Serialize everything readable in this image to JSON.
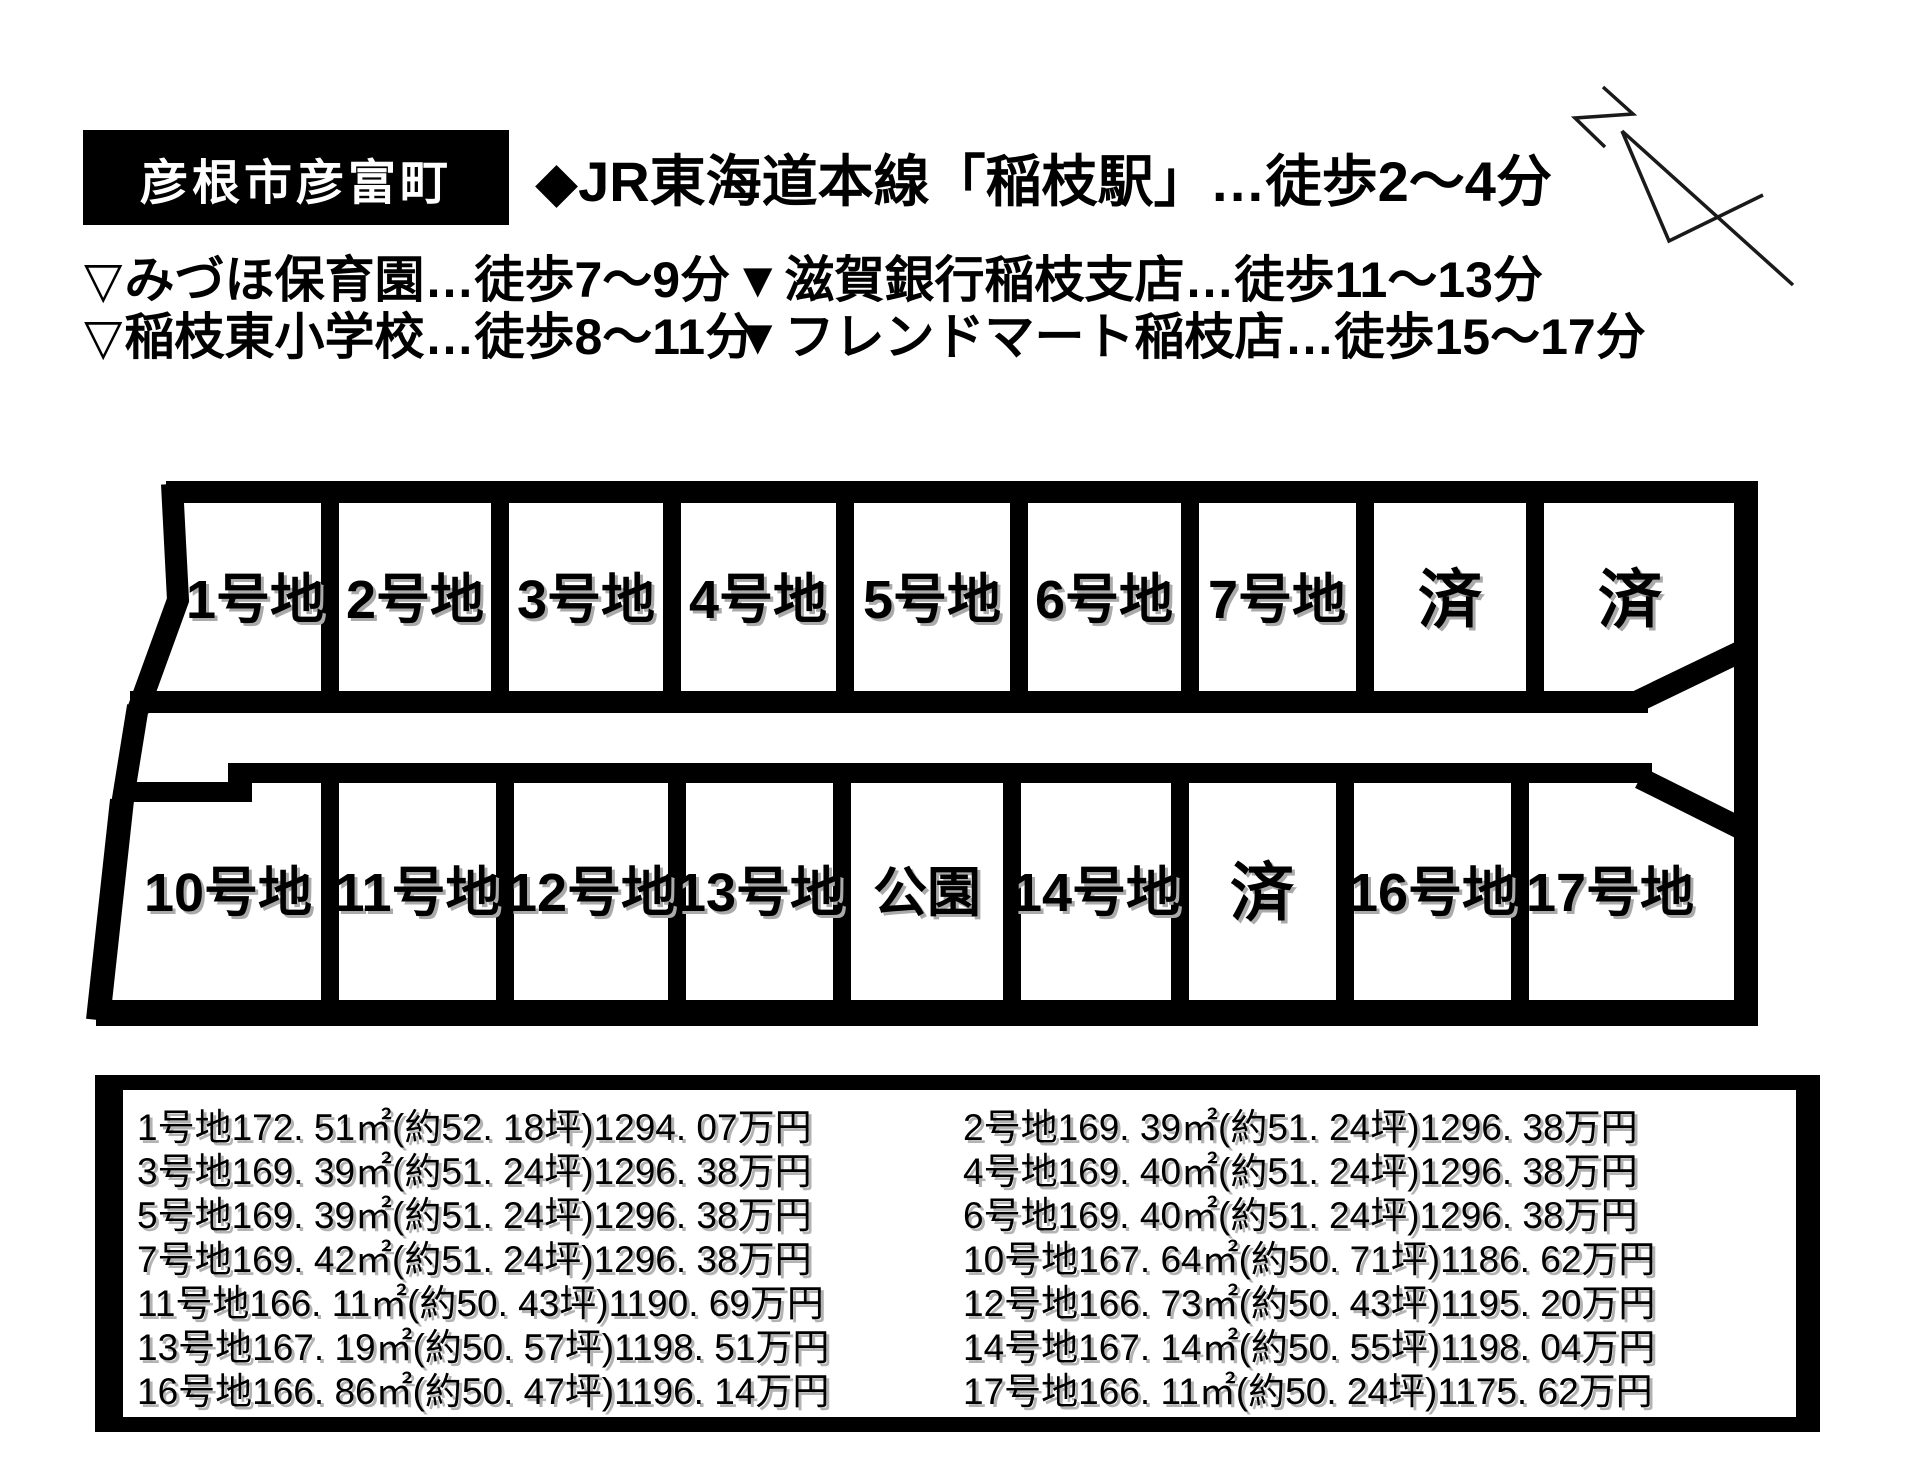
{
  "header": {
    "area_badge": "彦根市彦富町",
    "station_info": "◆JR東海道本線「稲枝駅」…徒歩2〜4分"
  },
  "facilities": {
    "left": [
      {
        "icon": "▽",
        "label": "みづほ保育園…徒歩7〜9分"
      },
      {
        "icon": "▽",
        "label": "稲枝東小学校…徒歩8〜11分"
      }
    ],
    "right": [
      {
        "icon": "▼",
        "label": "滋賀銀行稲枝支店…徒歩11〜13分"
      },
      {
        "icon": "▼",
        "label": "フレンドマート稲枝店…徒歩15〜17分"
      }
    ]
  },
  "site_plan": {
    "row1_labels": [
      "1号地",
      "2号地",
      "3号地",
      "4号地",
      "5号地",
      "6号地",
      "7号地",
      "済",
      "済"
    ],
    "row2_labels": [
      "10号地",
      "11号地",
      "12号地",
      "13号地",
      "公園",
      "14号地",
      "済",
      "16号地",
      "17号地"
    ],
    "border_color": "#000000"
  },
  "details": {
    "rows": [
      {
        "left": "1号地172. 51㎡(約52. 18坪)1294. 07万円",
        "right": "2号地169. 39㎡(約51. 24坪)1296. 38万円"
      },
      {
        "left": "3号地169. 39㎡(約51. 24坪)1296. 38万円",
        "right": "4号地169. 40㎡(約51. 24坪)1296. 38万円"
      },
      {
        "left": "5号地169. 39㎡(約51. 24坪)1296. 38万円",
        "right": "6号地169. 40㎡(約51. 24坪)1296. 38万円"
      },
      {
        "left": "7号地169. 42㎡(約51. 24坪)1296. 38万円",
        "right": "10号地167. 64㎡(約50. 71坪)1186. 62万円"
      },
      {
        "left": "11号地166. 11㎡(約50. 43坪)1190. 69万円",
        "right": "12号地166. 73㎡(約50. 43坪)1195. 20万円"
      },
      {
        "left": "13号地167. 19㎡(約50. 57坪)1198. 51万円",
        "right": "14号地167. 14㎡(約50. 55坪)1198. 04万円"
      },
      {
        "left": "16号地166. 86㎡(約50. 47坪)1196. 14万円",
        "right": "17号地166. 11㎡(約50. 24坪)1175. 62万円"
      }
    ]
  }
}
